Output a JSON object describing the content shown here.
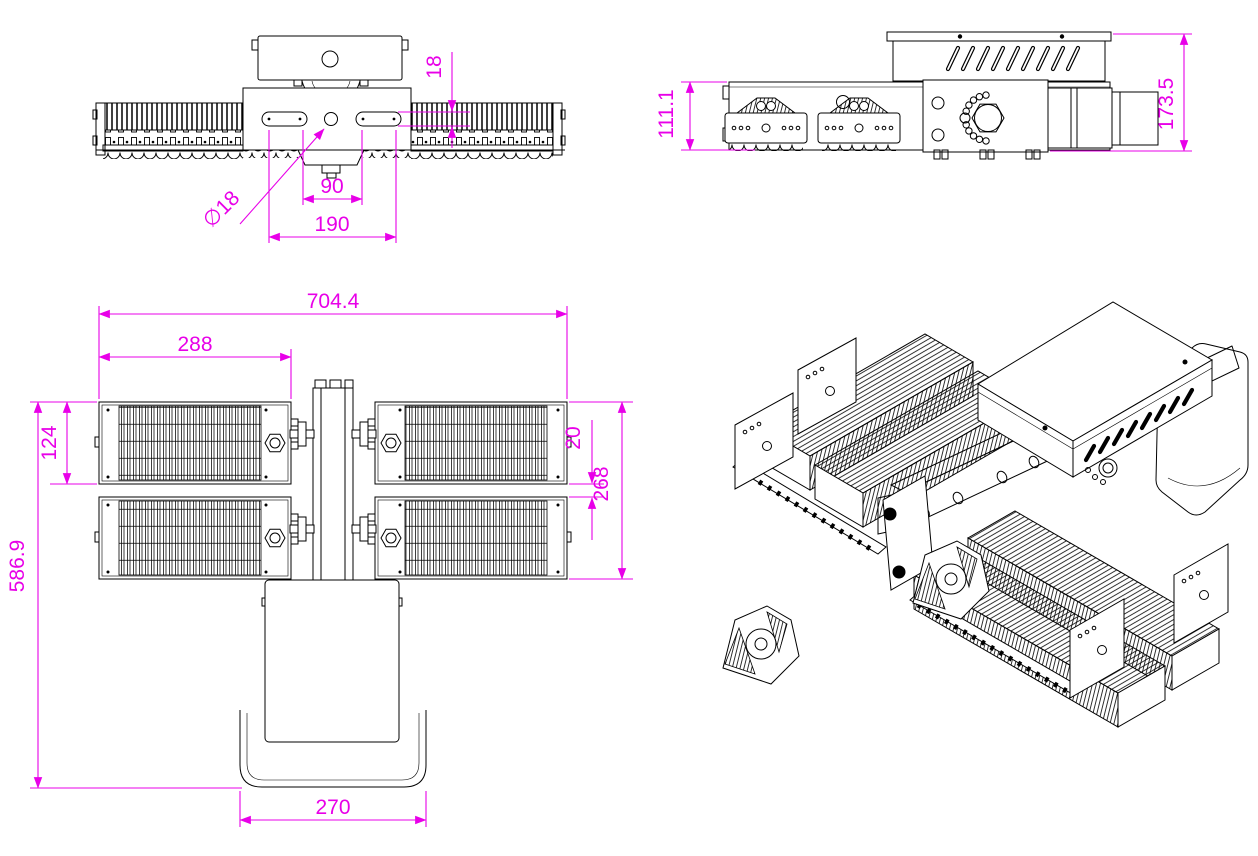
{
  "drawing": {
    "background": "#ffffff",
    "line_color": "#000000",
    "dimension_color": "#e800e8",
    "dimensions": {
      "top_view": {
        "slot_height": "18",
        "hole_diameter": "∅18",
        "inner_span": "90",
        "outer_span": "190"
      },
      "side_view": {
        "body_height": "111.1",
        "overall_height": "173.5"
      },
      "front_view": {
        "overall_width": "704.4",
        "module_width": "288",
        "module_height": "124",
        "module_gap": "20",
        "modules_span": "268",
        "overall_height": "586.9",
        "bracket_width": "270"
      }
    }
  }
}
